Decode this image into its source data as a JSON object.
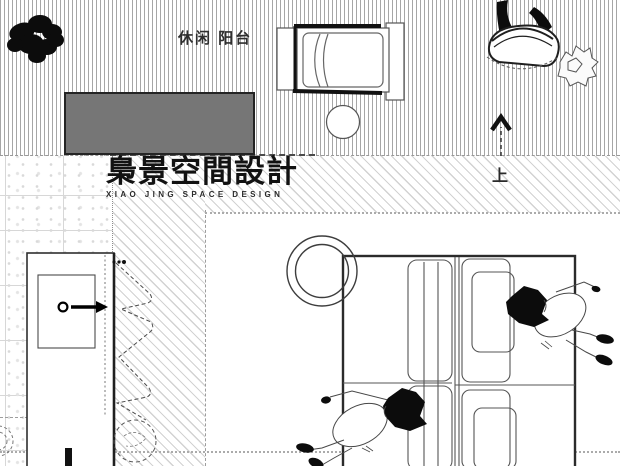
{
  "page": {
    "kind": "interior-floor-plan-render",
    "width_px": 620,
    "height_px": 466
  },
  "labels": {
    "balcony": "休闲 阳台",
    "direction_up": "上"
  },
  "logo": {
    "cn": "梟景空間設計",
    "en": "XIAO JING SPACE DESIGN"
  },
  "colors": {
    "background": "#ffffff",
    "mat_fill": "#767676",
    "mat_border": "#242424",
    "deck_hatch_line": "#a6a6a6",
    "diagonal_hatch_line": "#d2d2d2",
    "tile_grid_line": "#d7d7d7",
    "boundary_dotted": "#ababab",
    "drawing_line_dark": "#1a1a1a",
    "drawing_line_mid": "#555555",
    "silhouette_black": "#0c0c0c"
  },
  "icons": {
    "plant_silhouette": "potted-plant-top-view",
    "lounge_chair": "lounge-chair-plan",
    "side_table": "round-side-table-plan",
    "hanging_chair": "hanging-chair-plan",
    "shrub": "sketch-shrub",
    "stair_arrow": "up-direction-arrow",
    "cabinet": "cabinet-plan-with-swing-arrow",
    "curtain": "curtain-zigzag-symbol",
    "planter_dashed": "dashed-plant-circle",
    "sofa": "sectional-sofa-plan",
    "ring_decor": "round-tray-rings",
    "person_1": "person-lying-right",
    "person_2": "person-lying-left"
  }
}
